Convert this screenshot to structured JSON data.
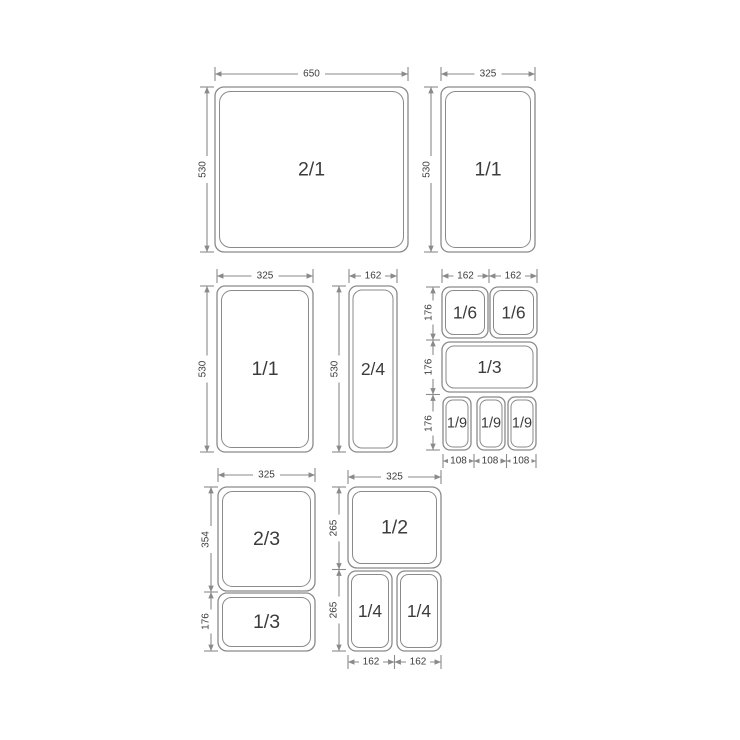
{
  "colors": {
    "line": "#8a8a8a",
    "text": "#3c3c3c",
    "background": "#ffffff"
  },
  "groups": {
    "double_full": {
      "pan": "2/1",
      "width": "650",
      "height": "530"
    },
    "full_top": {
      "pan": "1/1",
      "width": "325",
      "height": "530"
    },
    "full_mid": {
      "pan": "1/1",
      "width": "325",
      "height": "530"
    },
    "two_quarter": {
      "pan": "2/4",
      "width": "162",
      "height": "530"
    },
    "sixths_cluster": {
      "sixth_a": "1/6",
      "sixth_b": "1/6",
      "third": "1/3",
      "ninth_a": "1/9",
      "ninth_b": "1/9",
      "ninth_c": "1/9",
      "top_widths": [
        "162",
        "162"
      ],
      "row_heights": [
        "176",
        "176",
        "176"
      ],
      "bottom_widths": [
        "108",
        "108",
        "108"
      ]
    },
    "two_thirds_col": {
      "width": "325",
      "two_thirds": "2/3",
      "two_thirds_height": "354",
      "third": "1/3",
      "third_height": "176"
    },
    "half_col": {
      "width": "325",
      "half": "1/2",
      "half_height": "265",
      "quarter_a": "1/4",
      "quarter_b": "1/4",
      "quarter_height": "265",
      "bottom_widths": [
        "162",
        "162"
      ]
    }
  }
}
